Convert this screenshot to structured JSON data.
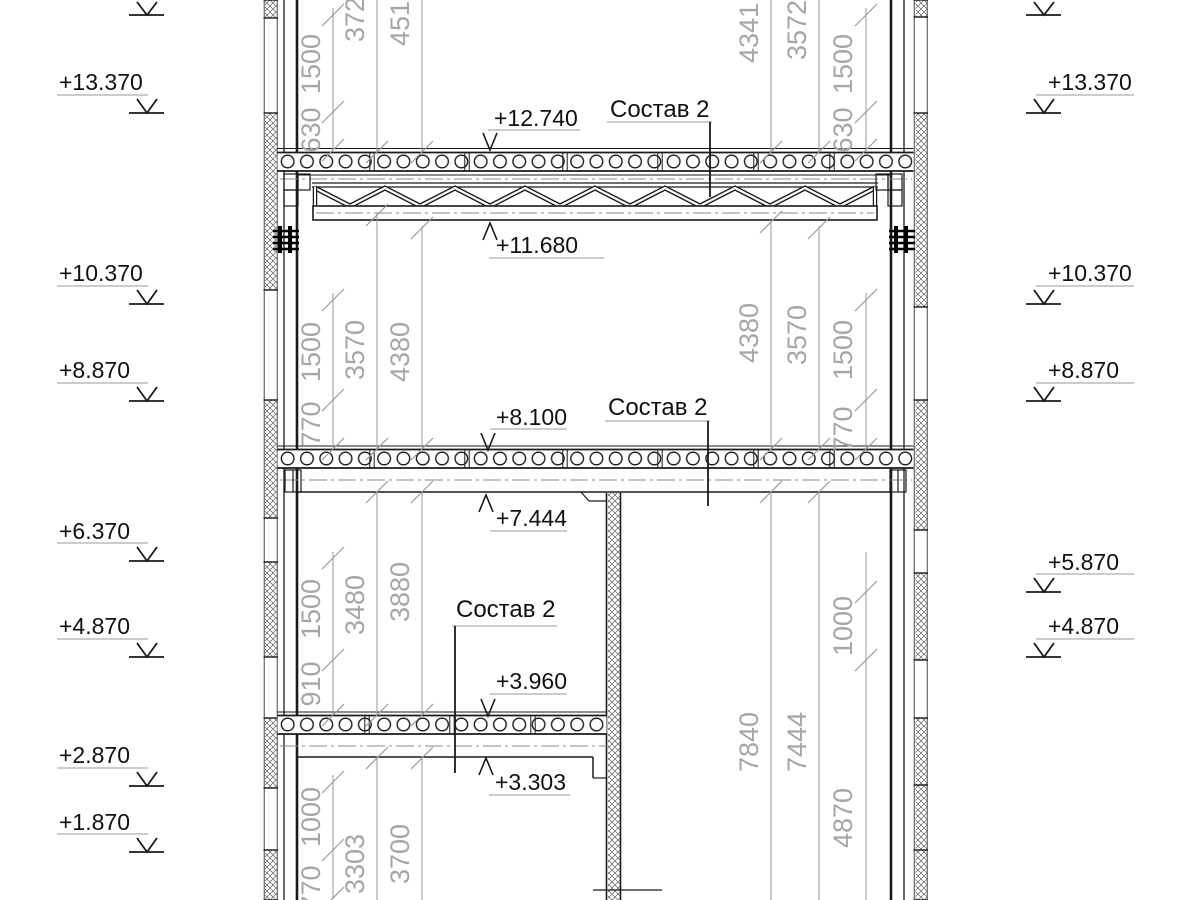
{
  "labels": {
    "composition": "Состав 2"
  },
  "elevations": {
    "left": [
      "+13.370",
      "+10.370",
      "+8.870",
      "+6.370",
      "+4.870",
      "+2.870",
      "+1.870"
    ],
    "right": [
      "+13.370",
      "+10.370",
      "+8.870",
      "+5.870",
      "+4.870"
    ],
    "interior": [
      "+12.740",
      "+11.680",
      "+8.100",
      "+7.444",
      "+3.960",
      "+3.303"
    ]
  },
  "dimensions": {
    "left_inner": [
      "1500",
      "630",
      "1500",
      "770",
      "1500",
      "910",
      "1000",
      "770"
    ],
    "left_mid": [
      "3720",
      "3570",
      "3480",
      "3303"
    ],
    "left_outer": [
      "4510",
      "4380",
      "3880",
      "3700"
    ],
    "right_outer": [
      "4341",
      "4380",
      "7840"
    ],
    "right_mid": [
      "3572",
      "3570",
      "7444"
    ],
    "right_inner": [
      "1500",
      "630",
      "1500",
      "770",
      "1000",
      "4870"
    ]
  }
}
